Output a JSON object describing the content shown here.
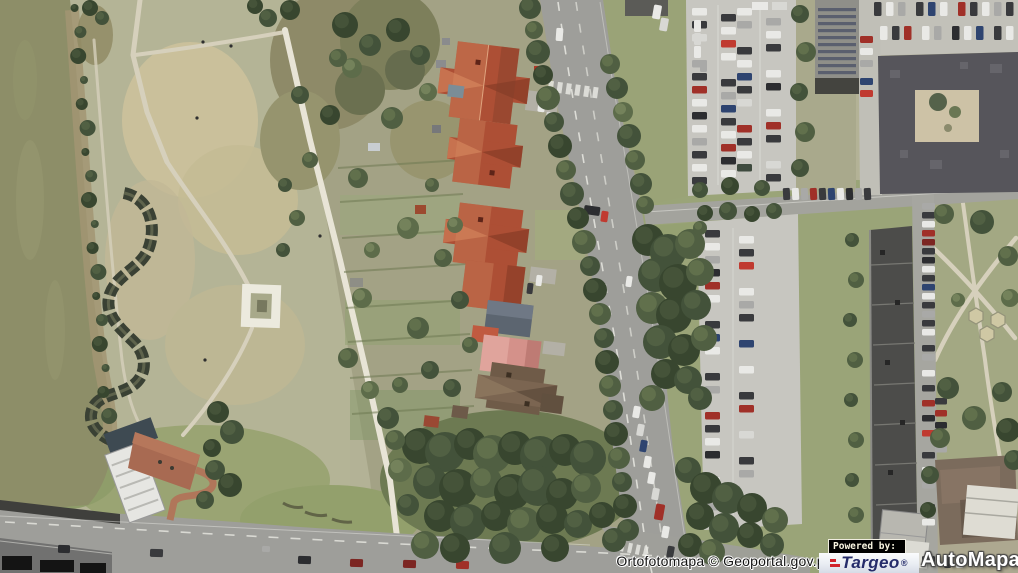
{
  "viewer": {
    "attribution": "Ortofotomapa © Geoportal.gov.pl",
    "branding": {
      "powered_by": "Powered by:",
      "targeo": "Targeo",
      "automapa": "AutoMapa",
      "registered": "®"
    }
  },
  "scene": {
    "description": "Aerial orthophoto tile: river on the left, park with serpentine wall and square monument, gardens and red-roof houses along a main road, parking lots, solar-roof building, large dark building with courtyard, long apartment block, small park with hexagonal pavilions, wide bridge road at the bottom.",
    "palette": {
      "water": "#8d8e68",
      "grass": "#b3b296",
      "dry_grass": "#cac09b",
      "trees_dark": "#38462f",
      "road": "#9e9e9a",
      "pavement": "#c7c6c0",
      "roof_red": "#ad4f35",
      "roof_pink": "#d4918a",
      "roof_brown": "#6f5b48",
      "building_dark": "#56555b",
      "logo_navy": "#252c6a",
      "logo_red": "#d1232a"
    }
  }
}
